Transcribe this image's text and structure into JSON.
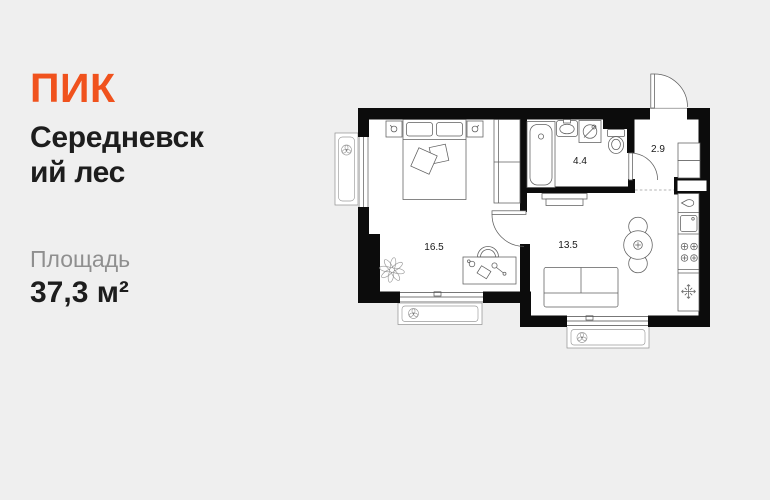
{
  "card": {
    "background_color": "#efefef",
    "brand": "ПИК",
    "brand_color": "#f0521d",
    "title_lines": [
      "Середневск",
      "ий лес"
    ],
    "area_label": "Площадь",
    "area_value": "37,3 м²"
  },
  "plan": {
    "wall_color": "#0c0c0c",
    "floor_color": "#ffffff",
    "rooms": [
      {
        "name": "bedroom",
        "area": "16.5"
      },
      {
        "name": "bathroom",
        "area": "4.4"
      },
      {
        "name": "hallway",
        "area": "2.9"
      },
      {
        "name": "living-kitchen",
        "area": "13.5"
      }
    ]
  }
}
